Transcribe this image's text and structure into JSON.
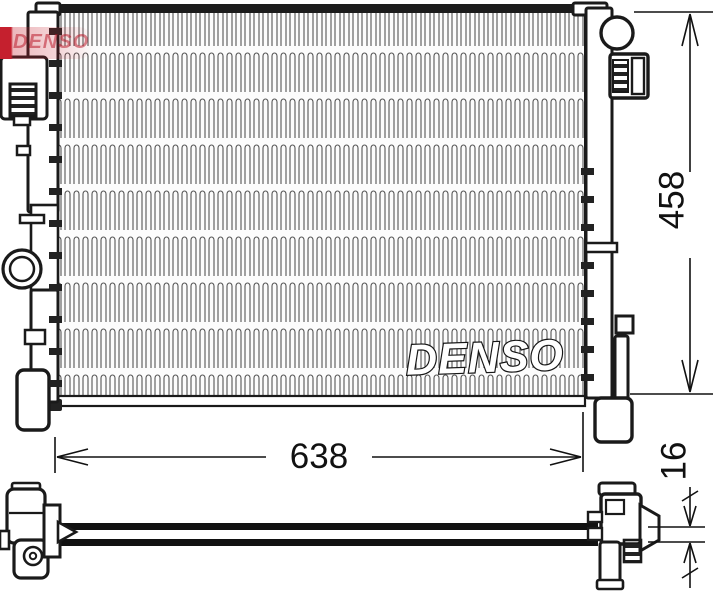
{
  "canvas": {
    "background": "#ffffff",
    "line_color": "#1a1a1a"
  },
  "watermark": {
    "text": "DENSO",
    "color": "#c5202e"
  },
  "radiator": {
    "brand_text": "DENSO"
  },
  "dimensions": {
    "core_width_mm": "638",
    "core_height_mm": "458",
    "core_depth_mm": "16"
  }
}
